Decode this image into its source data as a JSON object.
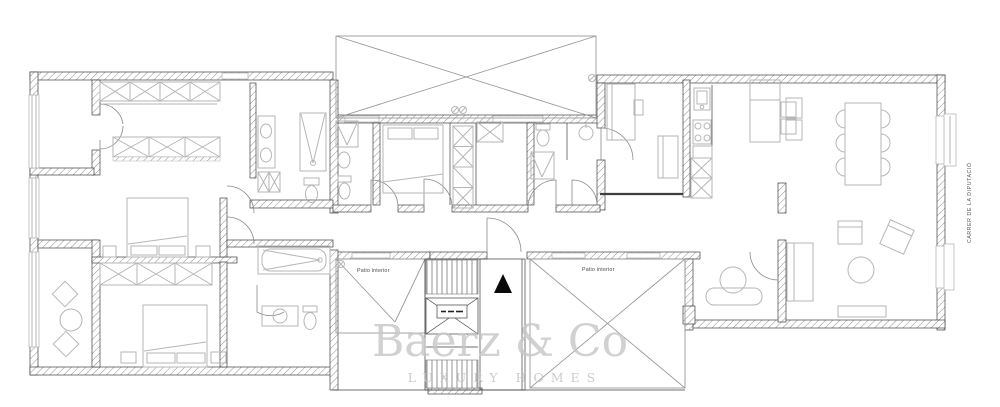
{
  "labels": {
    "patio_left": "Patio interior",
    "patio_right": "Patio interior",
    "street": "CARRER DE LA DIPUTACIÓ"
  },
  "watermark": {
    "line1": "Baerz & Co",
    "line2": "LUXURY HOMES"
  },
  "colors": {
    "bg": "#ffffff",
    "wall": "#3f3f3f",
    "hatch": "#8f8f8f",
    "furn": "#b6b6b6",
    "patio": "#9a9a9a",
    "text": "#4a4a4a",
    "wm": "#c6c6c6",
    "marker": "#0a0a0a"
  }
}
